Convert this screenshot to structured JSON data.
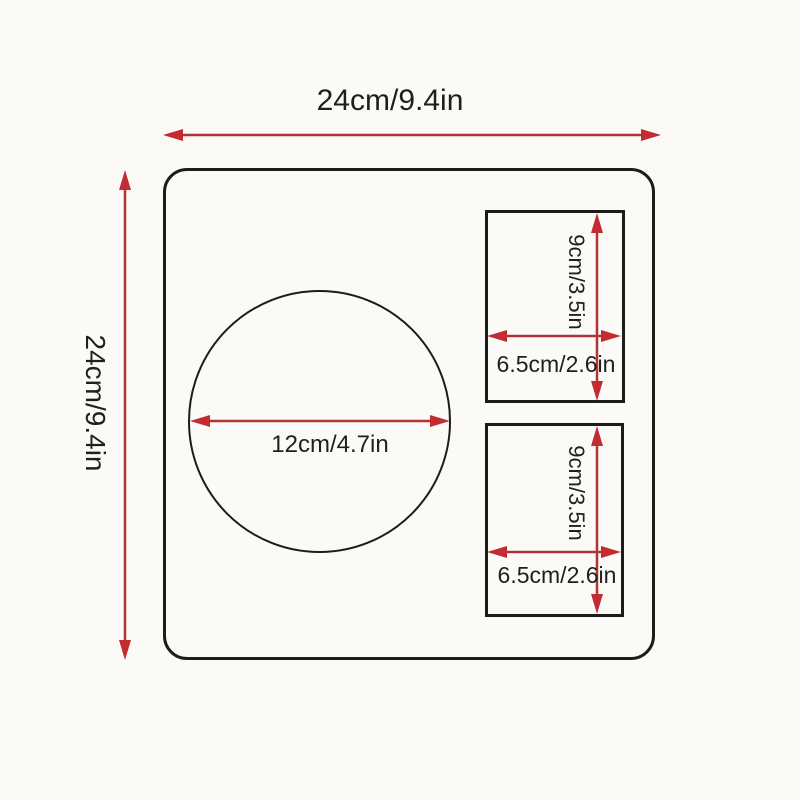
{
  "diagram": {
    "plate": {
      "width_label": "24cm/9.4in",
      "height_label": "24cm/9.4in"
    },
    "circle": {
      "diameter_label": "12cm/4.7in"
    },
    "pockets": [
      {
        "height_label": "9cm/3.5in",
        "width_label": "6.5cm/2.6in"
      },
      {
        "height_label": "9cm/3.5in",
        "width_label": "6.5cm/2.6in"
      }
    ],
    "colors": {
      "arrow_line": "#b23434",
      "arrow_head": "#c22b32",
      "outline": "#1c1c1c",
      "background": "#fbfaf7",
      "text": "#1f1f1f"
    }
  }
}
